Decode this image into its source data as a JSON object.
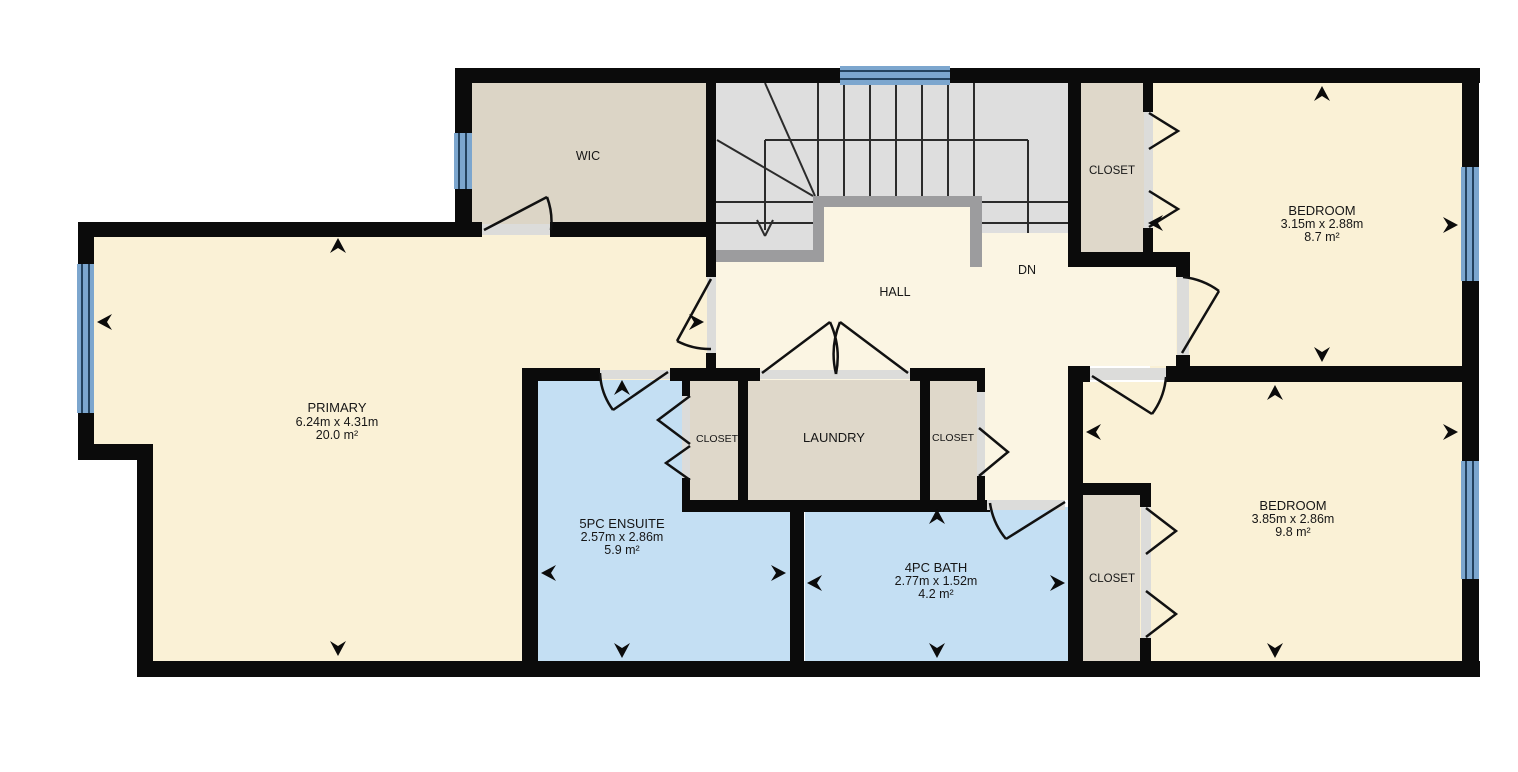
{
  "palette": {
    "wall": "#0b0b0b",
    "room_cream": "#FAF1D6",
    "hall_cream": "#FBF5E3",
    "taupe": "#DFD8CA",
    "wic_taupe": "#DCD5C6",
    "bath_blue": "#C4DFF3",
    "stair_gray": "#DEDEDE",
    "rail_gray": "#9C9C9E",
    "window_blue": "#7CA6CE",
    "window_line": "#24425E",
    "opening": "#DCDCDA",
    "text": "#161616"
  },
  "rooms": {
    "wic": {
      "label": "WIC"
    },
    "primary": {
      "label": "PRIMARY",
      "dims": "6.24m x 4.31m",
      "area": "20.0 m²"
    },
    "hall": {
      "label": "HALL"
    },
    "stairs_dn": {
      "label": "DN"
    },
    "ensuite": {
      "label": "5PC ENSUITE",
      "dims": "2.57m x 2.86m",
      "area": "5.9 m²"
    },
    "laundry": {
      "label": "LAUNDRY"
    },
    "bath": {
      "label": "4PC BATH",
      "dims": "2.77m x 1.52m",
      "area": "4.2 m²"
    },
    "bedroom_top": {
      "label": "BEDROOM",
      "dims": "3.15m x 2.88m",
      "area": "8.7 m²"
    },
    "bedroom_bottom": {
      "label": "BEDROOM",
      "dims": "3.85m x 2.86m",
      "area": "9.8 m²"
    },
    "closet_ensuite": {
      "label": "CLOSET"
    },
    "closet_hall": {
      "label": "CLOSET"
    },
    "closet_bed_top": {
      "label": "CLOSET"
    },
    "closet_bed_bottom": {
      "label": "CLOSET"
    }
  }
}
